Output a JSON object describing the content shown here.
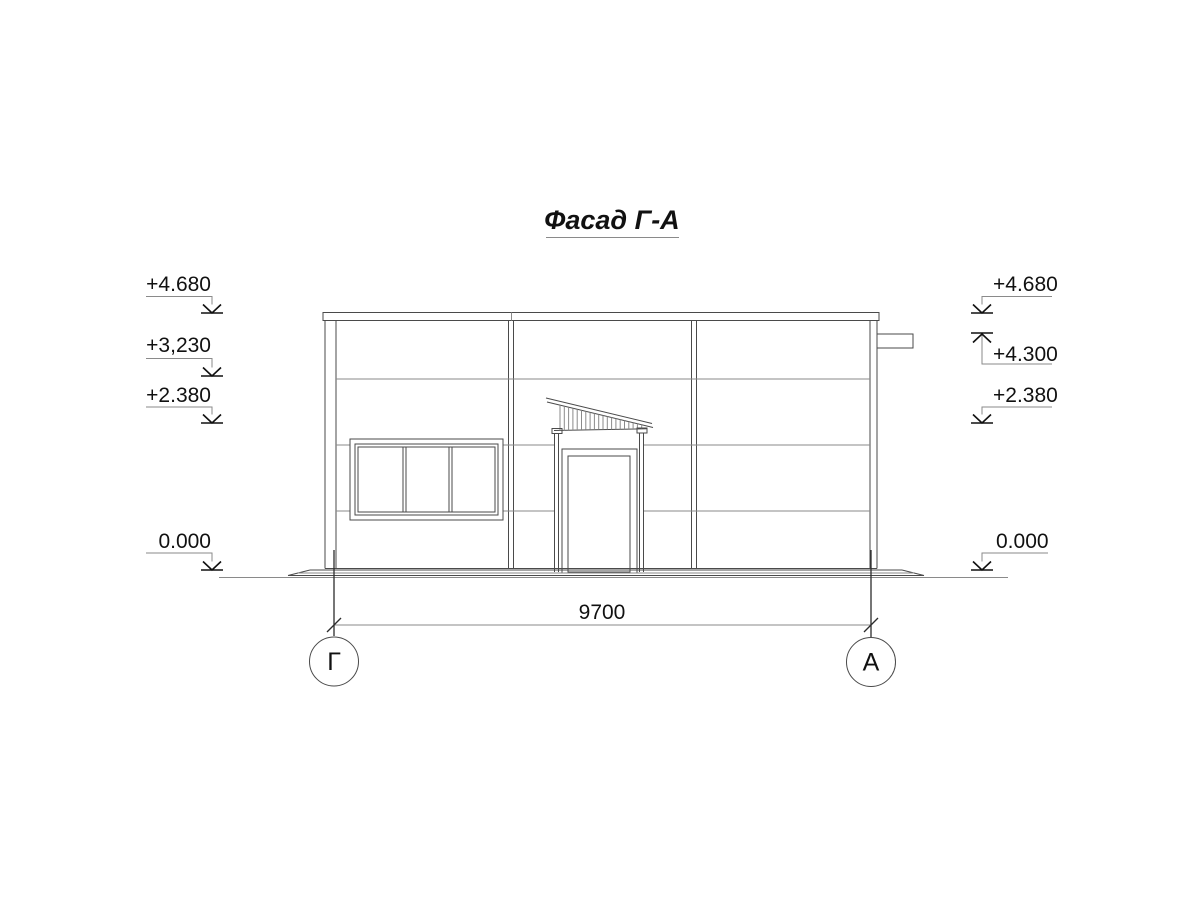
{
  "title": {
    "text": "Фасад Г-А"
  },
  "levels": {
    "left": [
      {
        "label": "+4.680"
      },
      {
        "label": "+3,230"
      },
      {
        "label": "+2.380"
      },
      {
        "label": "0.000"
      }
    ],
    "right": [
      {
        "label": "+4.680"
      },
      {
        "label": "+4.300"
      },
      {
        "label": "+2.380"
      },
      {
        "label": "0.000"
      }
    ]
  },
  "dimension": {
    "value": "9700"
  },
  "axes": {
    "left": "Г",
    "right": "А"
  },
  "colors": {
    "background": "#ffffff",
    "line": "#4a4a4a",
    "thin_line": "#8a8a8a",
    "text": "#111111"
  }
}
